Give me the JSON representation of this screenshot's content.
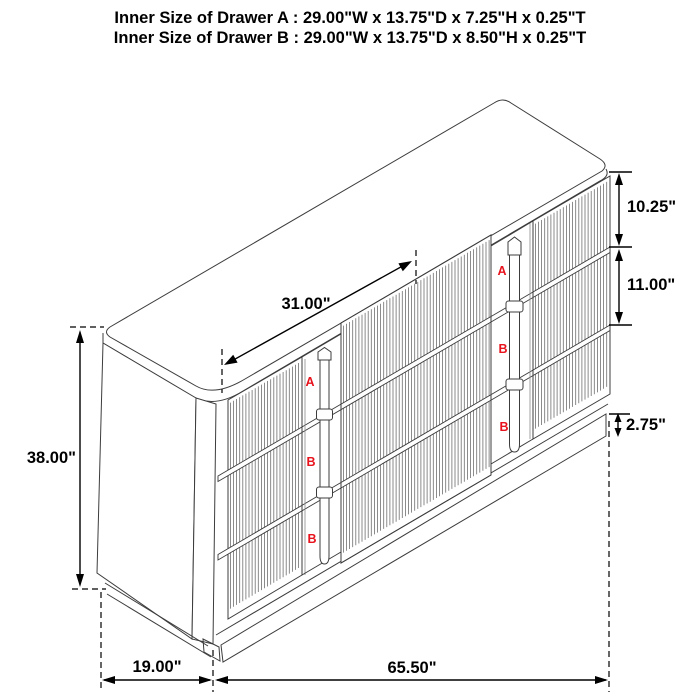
{
  "title": {
    "line1": "Inner Size of Drawer A : 29.00\"W x 13.75\"D x 7.25\"H x 0.25\"T",
    "line2": "Inner Size of Drawer B : 29.00\"W x 13.75\"D x 8.50\"H x 0.25\"T"
  },
  "dimensions": {
    "top_surface_width": "31.00\"",
    "overall_height": "38.00\"",
    "drawer_a_front_height": "10.25\"",
    "drawer_b_front_height": "11.00\"",
    "base_height": "2.75\"",
    "depth": "19.00\"",
    "overall_width": "65.50\""
  },
  "drawer_labels": {
    "left_column": [
      "A",
      "B",
      "B"
    ],
    "right_column": [
      "A",
      "B",
      "B"
    ]
  },
  "colors": {
    "diagram_line": "#3c3c3c",
    "dimension_line": "#000000",
    "drawer_label": "#e8131d",
    "background": "#ffffff"
  }
}
